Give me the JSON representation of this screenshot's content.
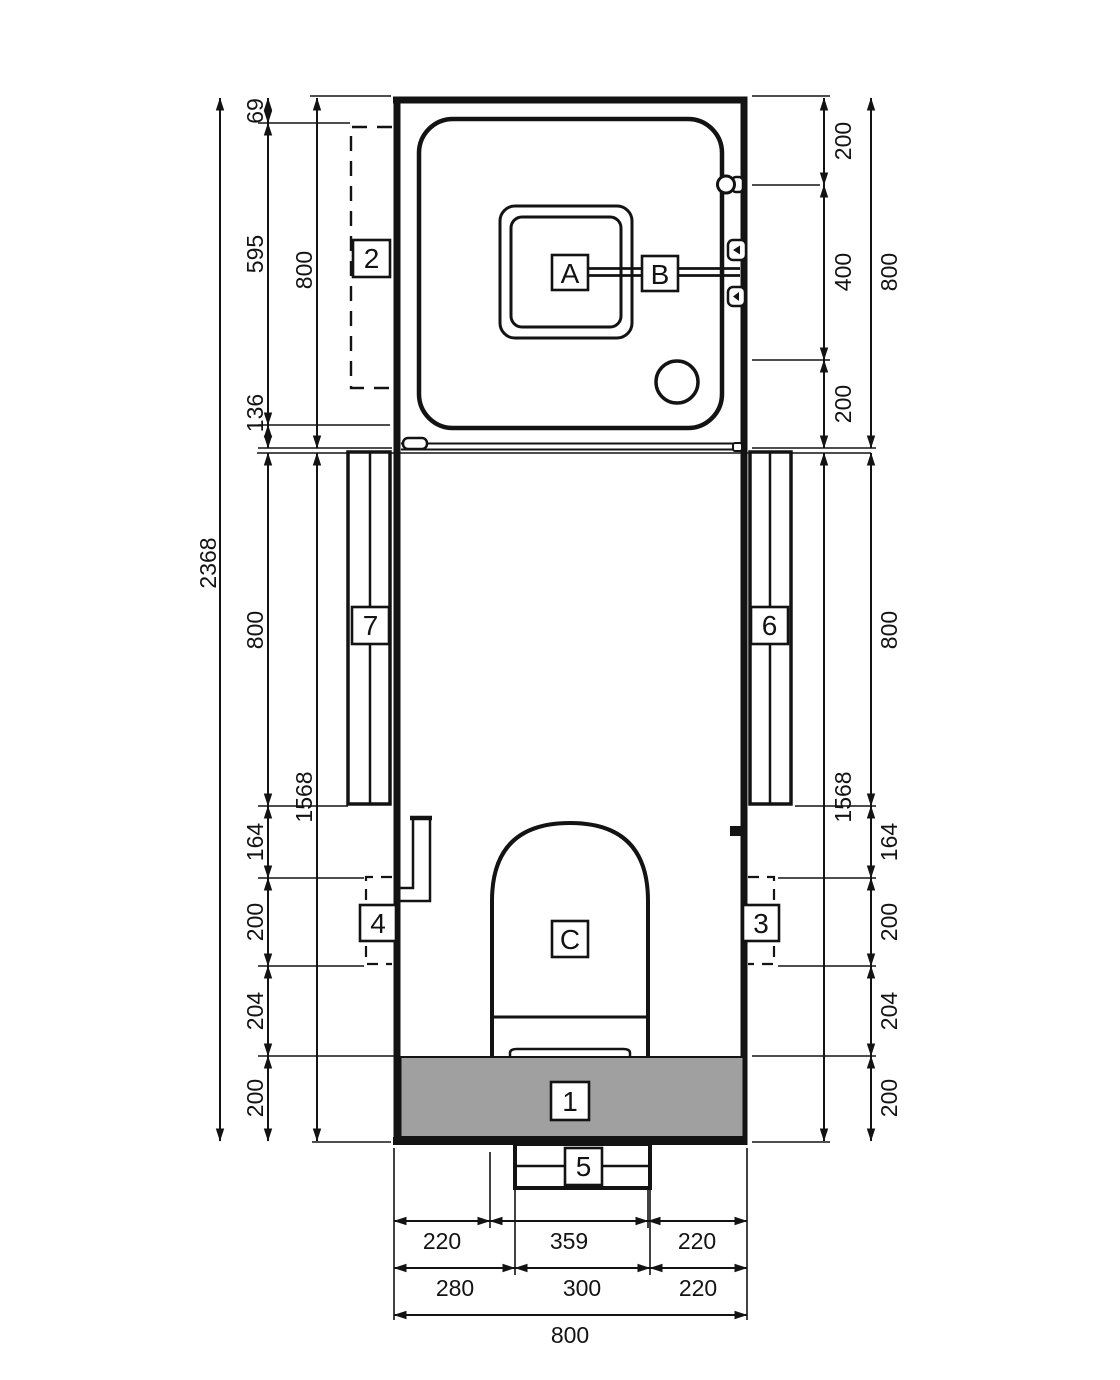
{
  "drawing": {
    "colors": {
      "line": "#131313",
      "gray": "#a0a0a0",
      "background": "#ffffff"
    }
  },
  "callouts": {
    "c1": "1",
    "c2": "2",
    "c3": "3",
    "c4": "4",
    "c5": "5",
    "c6": "6",
    "c7": "7",
    "cA": "A",
    "cB": "B",
    "cC": "C"
  },
  "dims": {
    "overall": "2368",
    "left_top_total": "800",
    "left_top": [
      "69",
      "595",
      "136"
    ],
    "left_bottom_total": "1568",
    "left_bottom": [
      "800",
      "164",
      "200",
      "204",
      "200"
    ],
    "right_top_total": "800",
    "right_top": [
      "200",
      "400",
      "200"
    ],
    "right_bottom_total": "1568",
    "right_bottom": [
      "800",
      "164",
      "200",
      "204",
      "200"
    ],
    "bottom_row1": [
      "220",
      "359",
      "220"
    ],
    "bottom_row2": [
      "280",
      "300",
      "220"
    ],
    "bottom_total": "800"
  }
}
